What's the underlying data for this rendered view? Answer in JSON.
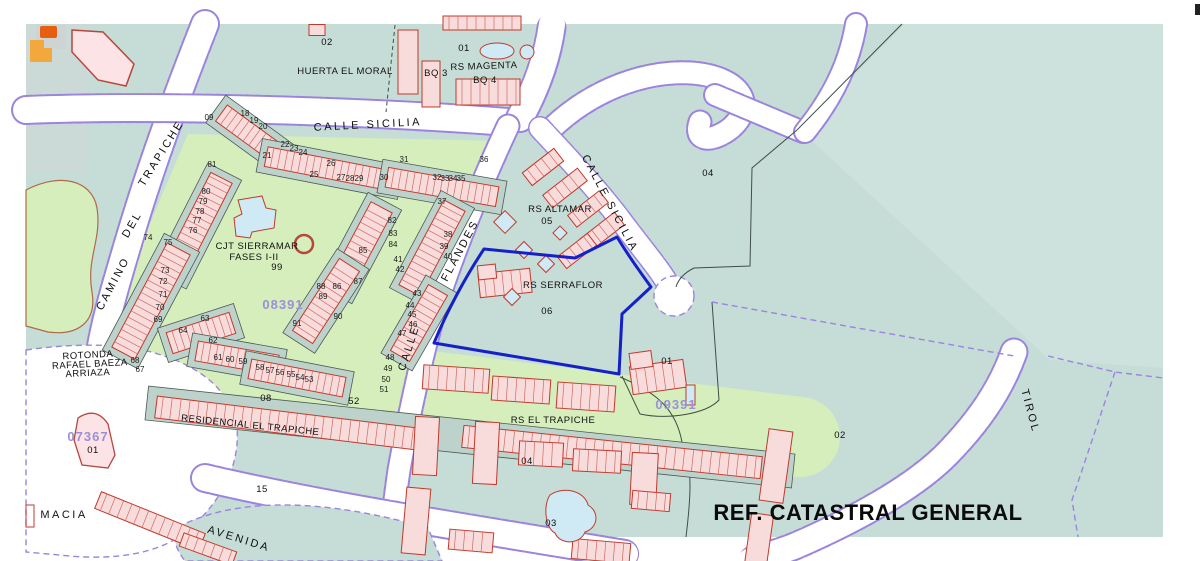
{
  "map": {
    "colors": {
      "teal": "#c6dcd6",
      "teal2": "#bed2cc",
      "teal_light": "#cde2dc",
      "green": "#d5eebb",
      "purple": "#9b84de",
      "blue": "#1620c8",
      "red": "#c0392b",
      "pink": "#f8dcdc",
      "pool": "#cfeaf4",
      "refpurple": "#9b8fd6",
      "orange": "#f2a83c",
      "orange_red": "#e55f0e"
    },
    "street_labels": [
      {
        "t": "CALLE SICILIA",
        "x": 368,
        "y": 128,
        "r": -3
      },
      {
        "t": "CALLE SICILIA",
        "x": 607,
        "y": 205,
        "r": 62
      },
      {
        "t": "CALLE",
        "x": 412,
        "y": 349,
        "r": -72
      },
      {
        "t": "FLANDES",
        "x": 463,
        "y": 252,
        "r": -62
      },
      {
        "t": "CAMINO",
        "x": 116,
        "y": 285,
        "r": -62
      },
      {
        "t": "DEL",
        "x": 135,
        "y": 226,
        "r": -60
      },
      {
        "t": "TRAPICHE",
        "x": 164,
        "y": 155,
        "r": -58
      },
      {
        "t": "AVENIDA",
        "x": 238,
        "y": 542,
        "r": 17
      },
      {
        "t": "TIROL",
        "x": 1027,
        "y": 412,
        "r": 75
      },
      {
        "t": "MACIA",
        "x": 64,
        "y": 518,
        "r": 0
      }
    ],
    "area_labels": [
      {
        "t": "HUERTA EL MORAL",
        "x": 345,
        "y": 74
      },
      {
        "t": "02",
        "x": 327,
        "y": 45
      },
      {
        "t": "01",
        "x": 464,
        "y": 51
      },
      {
        "t": "RS MAGENTA",
        "x": 484,
        "y": 69,
        "r": -2
      },
      {
        "t": "BQ 3",
        "x": 436,
        "y": 76
      },
      {
        "t": "BQ 4",
        "x": 485,
        "y": 83
      },
      {
        "t": "04",
        "x": 708,
        "y": 176
      },
      {
        "t": "RS ALTAMAR",
        "x": 560,
        "y": 212
      },
      {
        "t": "05",
        "x": 547,
        "y": 224
      },
      {
        "t": "RS SERRAFLOR",
        "x": 563,
        "y": 288
      },
      {
        "t": "06",
        "x": 547,
        "y": 314
      },
      {
        "t": "CJT SIERRAMAR",
        "x": 257,
        "y": 249
      },
      {
        "t": "FASES I-II",
        "x": 254,
        "y": 260
      },
      {
        "t": "99",
        "x": 277,
        "y": 270
      },
      {
        "t": "ROTONDA",
        "x": 88,
        "y": 358,
        "r": -3
      },
      {
        "t": "RAFAEL BAEZA",
        "x": 90,
        "y": 367,
        "r": -3
      },
      {
        "t": "ARRIAZA",
        "x": 88,
        "y": 376,
        "r": -3
      },
      {
        "t": "RESIDENCIAL EL TRAPICHE",
        "x": 250,
        "y": 428,
        "r": 6
      },
      {
        "t": "08",
        "x": 266,
        "y": 401
      },
      {
        "t": "52",
        "x": 354,
        "y": 404
      },
      {
        "t": "15",
        "x": 262,
        "y": 492
      },
      {
        "t": "RS EL TRAPICHE",
        "x": 553,
        "y": 423
      },
      {
        "t": "04",
        "x": 527,
        "y": 464
      },
      {
        "t": "03",
        "x": 551,
        "y": 526
      },
      {
        "t": "01",
        "x": 667,
        "y": 364
      },
      {
        "t": "01",
        "x": 93,
        "y": 453
      },
      {
        "t": "02",
        "x": 840,
        "y": 438
      }
    ],
    "parcel_numbers": [
      {
        "t": "09",
        "x": 209,
        "y": 120
      },
      {
        "t": "18",
        "x": 245,
        "y": 116
      },
      {
        "t": "19",
        "x": 254,
        "y": 123
      },
      {
        "t": "20",
        "x": 263,
        "y": 129
      },
      {
        "t": "21",
        "x": 267,
        "y": 158
      },
      {
        "t": "22",
        "x": 285,
        "y": 147
      },
      {
        "t": "23",
        "x": 294,
        "y": 151
      },
      {
        "t": "24",
        "x": 303,
        "y": 155
      },
      {
        "t": "25",
        "x": 314,
        "y": 177
      },
      {
        "t": "26",
        "x": 331,
        "y": 166
      },
      {
        "t": "27",
        "x": 341,
        "y": 180
      },
      {
        "t": "28",
        "x": 350,
        "y": 181
      },
      {
        "t": "29",
        "x": 359,
        "y": 181
      },
      {
        "t": "30",
        "x": 384,
        "y": 180
      },
      {
        "t": "31",
        "x": 404,
        "y": 162
      },
      {
        "t": "32",
        "x": 437,
        "y": 180
      },
      {
        "t": "33",
        "x": 445,
        "y": 181
      },
      {
        "t": "34",
        "x": 453,
        "y": 181
      },
      {
        "t": "35",
        "x": 461,
        "y": 181
      },
      {
        "t": "36",
        "x": 484,
        "y": 162
      },
      {
        "t": "37",
        "x": 442,
        "y": 204
      },
      {
        "t": "38",
        "x": 448,
        "y": 237
      },
      {
        "t": "39",
        "x": 444,
        "y": 249
      },
      {
        "t": "40",
        "x": 448,
        "y": 259
      },
      {
        "t": "41",
        "x": 398,
        "y": 262
      },
      {
        "t": "42",
        "x": 400,
        "y": 272
      },
      {
        "t": "43",
        "x": 417,
        "y": 296
      },
      {
        "t": "44",
        "x": 410,
        "y": 308
      },
      {
        "t": "45",
        "x": 412,
        "y": 317
      },
      {
        "t": "46",
        "x": 413,
        "y": 327
      },
      {
        "t": "47",
        "x": 402,
        "y": 336
      },
      {
        "t": "48",
        "x": 390,
        "y": 360
      },
      {
        "t": "49",
        "x": 388,
        "y": 371
      },
      {
        "t": "50",
        "x": 386,
        "y": 382
      },
      {
        "t": "51",
        "x": 384,
        "y": 392
      },
      {
        "t": "53",
        "x": 309,
        "y": 382
      },
      {
        "t": "54",
        "x": 300,
        "y": 380
      },
      {
        "t": "55",
        "x": 291,
        "y": 377
      },
      {
        "t": "56",
        "x": 280,
        "y": 375
      },
      {
        "t": "57",
        "x": 270,
        "y": 373
      },
      {
        "t": "58",
        "x": 260,
        "y": 370
      },
      {
        "t": "59",
        "x": 243,
        "y": 364
      },
      {
        "t": "60",
        "x": 230,
        "y": 362
      },
      {
        "t": "61",
        "x": 218,
        "y": 360
      },
      {
        "t": "62",
        "x": 213,
        "y": 343
      },
      {
        "t": "63",
        "x": 205,
        "y": 321
      },
      {
        "t": "64",
        "x": 183,
        "y": 333
      },
      {
        "t": "67",
        "x": 140,
        "y": 372
      },
      {
        "t": "68",
        "x": 135,
        "y": 363
      },
      {
        "t": "69",
        "x": 158,
        "y": 322
      },
      {
        "t": "70",
        "x": 160,
        "y": 310
      },
      {
        "t": "71",
        "x": 163,
        "y": 297
      },
      {
        "t": "72",
        "x": 163,
        "y": 284
      },
      {
        "t": "73",
        "x": 165,
        "y": 273
      },
      {
        "t": "74",
        "x": 148,
        "y": 240
      },
      {
        "t": "75",
        "x": 168,
        "y": 245
      },
      {
        "t": "76",
        "x": 193,
        "y": 233
      },
      {
        "t": "77",
        "x": 197,
        "y": 223
      },
      {
        "t": "78",
        "x": 200,
        "y": 214
      },
      {
        "t": "79",
        "x": 203,
        "y": 204
      },
      {
        "t": "80",
        "x": 206,
        "y": 194
      },
      {
        "t": "81",
        "x": 212,
        "y": 167
      },
      {
        "t": "82",
        "x": 392,
        "y": 223
      },
      {
        "t": "83",
        "x": 393,
        "y": 236
      },
      {
        "t": "84",
        "x": 393,
        "y": 247
      },
      {
        "t": "85",
        "x": 363,
        "y": 253
      },
      {
        "t": "86",
        "x": 337,
        "y": 289
      },
      {
        "t": "87",
        "x": 358,
        "y": 284
      },
      {
        "t": "88",
        "x": 321,
        "y": 289
      },
      {
        "t": "89",
        "x": 323,
        "y": 299
      },
      {
        "t": "90",
        "x": 338,
        "y": 319
      },
      {
        "t": "91",
        "x": 297,
        "y": 326
      }
    ],
    "ref_numbers": [
      {
        "t": "08391",
        "x": 283,
        "y": 309
      },
      {
        "t": "09391",
        "x": 676,
        "y": 409
      },
      {
        "t": "07367",
        "x": 88,
        "y": 441
      }
    ],
    "footer_label": {
      "t": "REF. CATASTRAL GENERAL",
      "x": 868,
      "y": 520
    }
  }
}
